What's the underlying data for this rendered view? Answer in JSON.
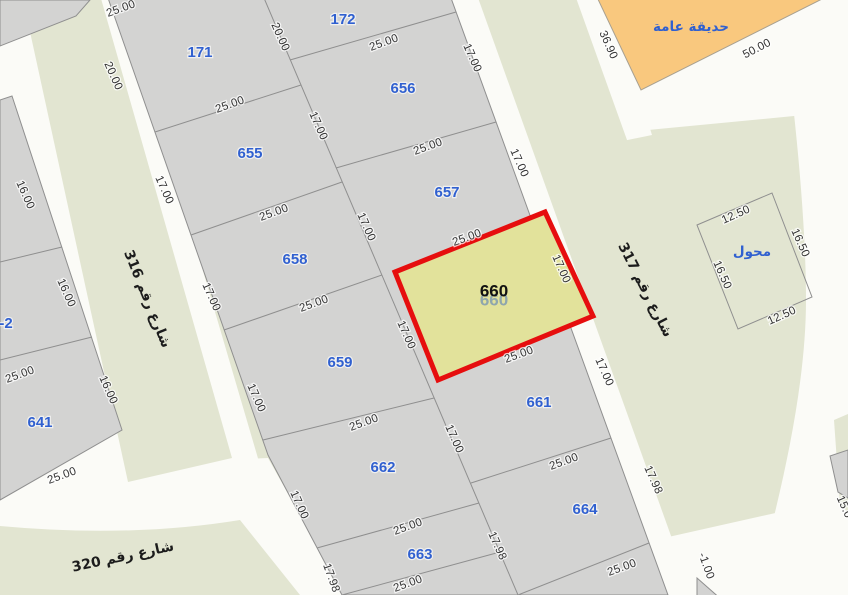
{
  "map": {
    "highlighted_parcel": "660",
    "colors": {
      "land_green": "#e2e5d1",
      "road_white": "#fbfbf7",
      "parcel_gray": "#d3d3d2",
      "parcel_stroke": "#8f8f8f",
      "garden_orange": "#f9c87e",
      "highlight_fill": "#e2e29b",
      "highlight_red": "#e60e0e",
      "number_blue": "#3060d0",
      "dim_text": "#333333"
    },
    "parcel_labels": [
      {
        "t": "171",
        "x": 200,
        "y": 53
      },
      {
        "t": "172",
        "x": 343,
        "y": 20
      },
      {
        "t": "655",
        "x": 250,
        "y": 154
      },
      {
        "t": "656",
        "x": 403,
        "y": 89
      },
      {
        "t": "657",
        "x": 447,
        "y": 193
      },
      {
        "t": "658",
        "x": 295,
        "y": 260
      },
      {
        "t": "659",
        "x": 340,
        "y": 363
      },
      {
        "t": "661",
        "x": 539,
        "y": 403
      },
      {
        "t": "662",
        "x": 383,
        "y": 468
      },
      {
        "t": "663",
        "x": 420,
        "y": 555
      },
      {
        "t": "664",
        "x": 585,
        "y": 510
      },
      {
        "t": "641",
        "x": 40,
        "y": 423
      },
      {
        "t": "-2",
        "x": 6,
        "y": 324
      }
    ],
    "highlight_labels": {
      "shadow": {
        "t": "660",
        "x": 494,
        "y": 301
      },
      "main": {
        "t": "660",
        "x": 494,
        "y": 292
      }
    },
    "area_labels": [
      {
        "t": "حديقة عامة",
        "x": 691,
        "y": 27,
        "name": "public-garden-label"
      },
      {
        "t": "محول",
        "x": 752,
        "y": 252,
        "name": "transformer-label"
      }
    ],
    "street_labels": [
      {
        "t": "شارع رقم 316",
        "x": 147,
        "y": 299,
        "r": 68,
        "name": "street-316-label"
      },
      {
        "t": "شارع رقم 317",
        "x": 645,
        "y": 290,
        "r": 63,
        "name": "street-317-label"
      },
      {
        "t": "شارع رقم 320",
        "x": 123,
        "y": 557,
        "r": -12,
        "name": "street-320-label"
      }
    ],
    "dimension_labels": [
      {
        "t": "25.00",
        "x": 121,
        "y": 9,
        "r": -20
      },
      {
        "t": "20.00",
        "x": 280,
        "y": 37,
        "r": 66
      },
      {
        "t": "25.00",
        "x": 384,
        "y": 43,
        "r": -20
      },
      {
        "t": "17.00",
        "x": 472,
        "y": 58,
        "r": 66
      },
      {
        "t": "36.90",
        "x": 608,
        "y": 45,
        "r": 66
      },
      {
        "t": "50.00",
        "x": 757,
        "y": 49,
        "r": -27
      },
      {
        "t": "20.00",
        "x": 113,
        "y": 76,
        "r": 66
      },
      {
        "t": "25.00",
        "x": 230,
        "y": 105,
        "r": -20
      },
      {
        "t": "17.00",
        "x": 318,
        "y": 126,
        "r": 66
      },
      {
        "t": "25.00",
        "x": 428,
        "y": 147,
        "r": -20
      },
      {
        "t": "17.00",
        "x": 519,
        "y": 163,
        "r": 66
      },
      {
        "t": "16.00",
        "x": 25,
        "y": 195,
        "r": 66
      },
      {
        "t": "17.00",
        "x": 164,
        "y": 190,
        "r": 66
      },
      {
        "t": "25.00",
        "x": 274,
        "y": 213,
        "r": -20
      },
      {
        "t": "17.00",
        "x": 366,
        "y": 227,
        "r": 66
      },
      {
        "t": "25.00",
        "x": 467,
        "y": 238,
        "r": -20
      },
      {
        "t": "12.50",
        "x": 736,
        "y": 215,
        "r": -24
      },
      {
        "t": "16.50",
        "x": 800,
        "y": 243,
        "r": 66
      },
      {
        "t": "17.00",
        "x": 561,
        "y": 269,
        "r": 66,
        "c": "#8f7a1a"
      },
      {
        "t": "16.50",
        "x": 722,
        "y": 275,
        "r": 66
      },
      {
        "t": "25.00",
        "x": 20,
        "y": 375,
        "r": -20
      },
      {
        "t": "16.00",
        "x": 66,
        "y": 293,
        "r": 66
      },
      {
        "t": "17.00",
        "x": 211,
        "y": 297,
        "r": 66
      },
      {
        "t": "25.00",
        "x": 314,
        "y": 304,
        "r": -20
      },
      {
        "t": "17.00",
        "x": 406,
        "y": 335,
        "r": 66
      },
      {
        "t": "12.50",
        "x": 782,
        "y": 316,
        "r": -24
      },
      {
        "t": "25.00",
        "x": 519,
        "y": 355,
        "r": -20
      },
      {
        "t": "17.00",
        "x": 604,
        "y": 372,
        "r": 66
      },
      {
        "t": "16.00",
        "x": 108,
        "y": 390,
        "r": 66
      },
      {
        "t": "17.00",
        "x": 256,
        "y": 398,
        "r": 66
      },
      {
        "t": "25.00",
        "x": 364,
        "y": 423,
        "r": -20
      },
      {
        "t": "17.00",
        "x": 454,
        "y": 439,
        "r": 66
      },
      {
        "t": "25.00",
        "x": 564,
        "y": 462,
        "r": -20
      },
      {
        "t": "25.00",
        "x": 62,
        "y": 476,
        "r": -20
      },
      {
        "t": "17.98",
        "x": 653,
        "y": 480,
        "r": 66
      },
      {
        "t": "17.00",
        "x": 299,
        "y": 505,
        "r": 66
      },
      {
        "t": "15.0",
        "x": 844,
        "y": 507,
        "r": 66
      },
      {
        "t": "25.00",
        "x": 408,
        "y": 527,
        "r": -20
      },
      {
        "t": "17.98",
        "x": 497,
        "y": 546,
        "r": 66
      },
      {
        "t": "-1.00",
        "x": 706,
        "y": 566,
        "r": 70
      },
      {
        "t": "17.98",
        "x": 331,
        "y": 578,
        "r": 70
      },
      {
        "t": "25.00",
        "x": 408,
        "y": 584,
        "r": -20
      },
      {
        "t": "25.00",
        "x": 622,
        "y": 568,
        "r": -20
      }
    ]
  }
}
